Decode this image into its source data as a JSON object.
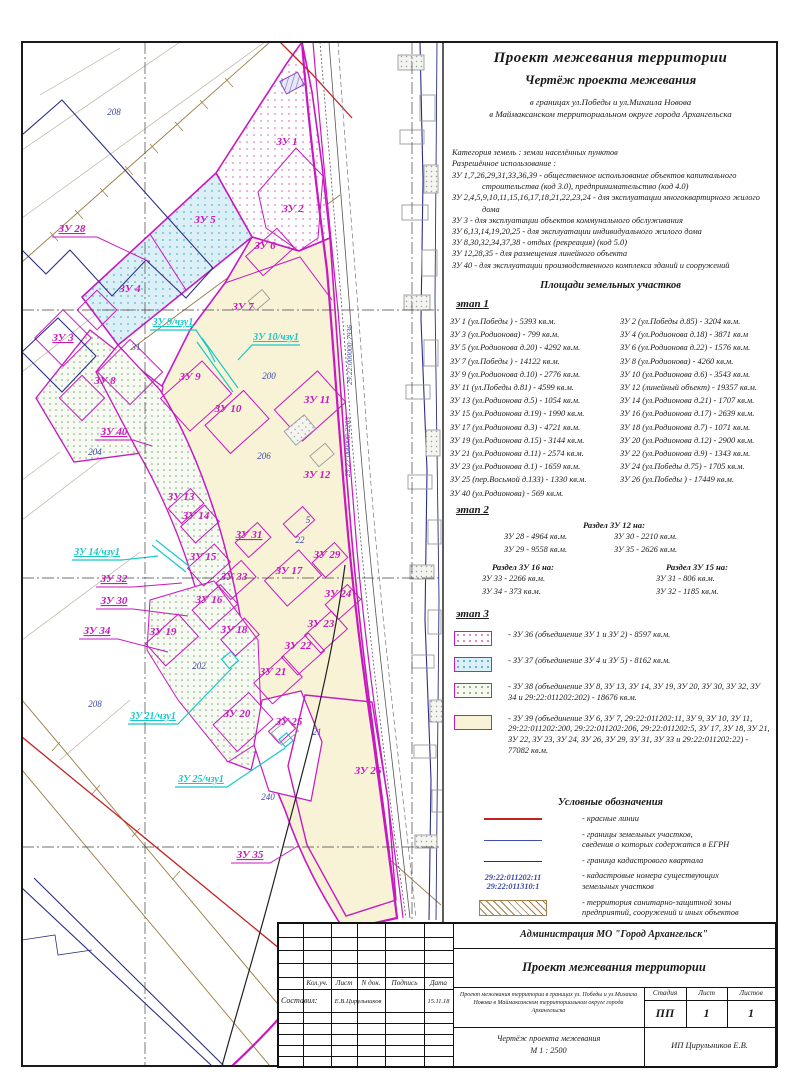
{
  "header": {
    "title": "Проект межевания территории",
    "subtitle": "Чертёж проекта межевания",
    "scope_line1": "в границах ул.Победы и ул.Михаила Новова",
    "scope_line2": "в Маймаксанском территориальном округе города Архангельска"
  },
  "category": {
    "line1": "Категория земель : земли населённых пунктов",
    "line2": "Разрешённое использование :",
    "uses": [
      "ЗУ 1,7,26,29,31,33,36,39 - общественное использование объектов капитального строительства (код 3.0), предпринимательство (код 4.0)",
      "ЗУ 2,4,5,9,10,11,15,16,17,18,21,22,23,24 - для эксплуатации многоквартирного жилого дома",
      "ЗУ 3 - для эксплуатации объектов коммунального обслуживания",
      "ЗУ 6,13,14,19,20,25 - для эксплуатации индивидуального жилого дома",
      "ЗУ 8,30,32,34,37,38 - отдых (рекреация) (код 5.0)",
      "ЗУ 12,28,35 - для размещения линейного объекта",
      "ЗУ 40 - для эксплуатации производственного комплекса зданий и сооружений"
    ]
  },
  "areas": {
    "heading": "Площади земельных участков",
    "stage1": {
      "label": "этап 1",
      "rows": [
        {
          "left": "ЗУ 1 (ул.Победы ) - 5393 кв.м.",
          "right": "ЗУ 2 (ул.Победы д.85) - 3204 кв.м."
        },
        {
          "left": "ЗУ 3 (ул.Родионова) - 799 кв.м.",
          "right": "ЗУ 4 (ул.Родионова д.18) - 3871 кв.м"
        },
        {
          "left": "ЗУ 5 (ул.Родионова д.20) - 4292 кв.м.",
          "right": "ЗУ 6 (ул.Родионова д.22) - 1576 кв.м."
        },
        {
          "left": "ЗУ 7 (ул.Победы ) - 14122 кв.м.",
          "right": "ЗУ 8 (ул.Родионова) - 4260 кв.м."
        },
        {
          "left": "ЗУ 9 (ул.Родионова д.10) - 2776 кв.м.",
          "right": "ЗУ 10 (ул.Родионова д.6) - 3543 кв.м."
        },
        {
          "left": "ЗУ 11 (ул.Победы д.81) - 4599 кв.м.",
          "right": "ЗУ 12 (линейный объект) - 19357 кв.м."
        },
        {
          "left": "ЗУ 13 (ул.Родионова д.5) - 1054 кв.м.",
          "right": "ЗУ 14 (ул.Родионова д.21) - 1707 кв.м."
        },
        {
          "left": "ЗУ 15 (ул.Родионова д.19) - 1990 кв.м.",
          "right": "ЗУ 16 (ул.Родионова д.17) - 2639 кв.м."
        },
        {
          "left": "ЗУ 17 (ул.Родионова д.3) - 4721 кв.м.",
          "right": "ЗУ 18 (ул.Родионова д.7) - 1071 кв.м."
        },
        {
          "left": "ЗУ 19 (ул.Родионова д.15) - 3144 кв.м.",
          "right": "ЗУ 20 (ул.Родионова д.12) - 2900 кв.м."
        },
        {
          "left": "ЗУ 21 (ул.Родионова д.11) - 2574 кв.м.",
          "right": "ЗУ 22 (ул.Родионова д.9) - 1343 кв.м."
        },
        {
          "left": "ЗУ 23 (ул.Родионова д.1) - 1659 кв.м.",
          "right": "ЗУ 24 (ул.Победы д.75) - 1705 кв.м."
        },
        {
          "left": "ЗУ 25 (пер.Восьмой д.133) - 1330 кв.м.",
          "right": "ЗУ 26 (ул.Победы ) - 17449 кв.м."
        },
        {
          "left": "ЗУ 40 (ул.Родионова) - 569 кв.м.",
          "right": ""
        }
      ]
    },
    "stage2": {
      "label": "этап 2",
      "split12": {
        "title": "Раздел ЗУ 12 на:",
        "left": [
          "ЗУ 28 - 4964 кв.м.",
          "ЗУ 29 - 9558 кв.м."
        ],
        "right": [
          "ЗУ 30 - 2210 кв.м.",
          "ЗУ 35 - 2626 кв.м."
        ]
      },
      "split16": {
        "title": "Раздел ЗУ 16 на:",
        "rows": [
          "ЗУ 33 - 2266 кв.м.",
          "ЗУ 34 - 373 кв.м."
        ]
      },
      "split15": {
        "title": "Раздел ЗУ 15 на:",
        "rows": [
          "ЗУ 31 - 806 кв.м.",
          "ЗУ 32 - 1185 кв.м."
        ]
      }
    },
    "stage3": {
      "label": "этап 3",
      "items": [
        {
          "swatch": "pink",
          "text": "- ЗУ 36 (объединение ЗУ 1 и ЗУ 2) - 8597 кв.м."
        },
        {
          "swatch": "cyan",
          "text": "- ЗУ 37 (объединение ЗУ 4 и ЗУ 5) - 8162 кв.м."
        },
        {
          "swatch": "green",
          "text": "- ЗУ 38 (объединение ЗУ 8, ЗУ 13, ЗУ 14, ЗУ 19, ЗУ 20, ЗУ 30, ЗУ 32, ЗУ 34 и 29:22:011202:202) - 18676 кв.м."
        },
        {
          "swatch": "beige",
          "text": "- ЗУ 39 (объединение ЗУ 6, ЗУ 7, 29:22:011202:11, ЗУ 9, ЗУ 10, ЗУ 11, 29:22:011202:200, 29:22:011202:206, 29:22:011202:5, ЗУ 17, ЗУ 18, ЗУ 21, ЗУ 22, ЗУ 23, ЗУ 24, ЗУ 26, ЗУ 29, ЗУ 31, ЗУ 33 и 29:22:011202:22) - 77082 кв.м."
        }
      ]
    }
  },
  "legend": {
    "heading": "Условные обозначения",
    "items": [
      {
        "symbol": "red-line",
        "lines": [
          "- красные линии"
        ]
      },
      {
        "symbol": "egrn-line",
        "lines": [
          "- границы земельных участков,",
          "сведения о которых содержатся в ЕГРН"
        ]
      },
      {
        "symbol": "quarter-line",
        "lines": [
          "- граница кадастрового квартала"
        ]
      },
      {
        "symbol": "cadastral-numbers",
        "numbers": [
          "29:22:011202:11",
          "29:22:011310:1"
        ],
        "lines": [
          "- кадастровые номера существующих",
          "земельных участков"
        ]
      },
      {
        "symbol": "szz-hatch",
        "lines": [
          "- территория санитарно-защитной зоны",
          "предприятий, сооружений и иных объектов"
        ]
      },
      {
        "symbol": "planned-rect",
        "lines": [
          "- границы земельных участков,",
          "планируемых к предоставлению"
        ]
      }
    ]
  },
  "title_block": {
    "org": "Администрация МО \"Город Архангельск\"",
    "doc_title": "Проект межевания территории",
    "col_headers": [
      "Кол.уч.",
      "Лист",
      "N док.",
      "Подпись",
      "Дата"
    ],
    "compiled_label": "Составил:",
    "compiled_name": "Е.В.Цирульников",
    "compiled_date": "15.11.18",
    "description": "Проект межевания территории в границах ул. Победы и ул.Михаила Новова в Маймаксанском территориальном округе города Архангельска",
    "stage_label": "Стадия",
    "sheet_label": "Лист",
    "sheets_label": "Листов",
    "stage_value": "ПП",
    "sheet_value": "1",
    "sheets_value": "1",
    "drawing_title": "Чертёж проекта межевания",
    "scale": "М 1 : 2500",
    "company": "ИП Цирульников Е.В."
  },
  "colors": {
    "plot_boundary": "#c818c0",
    "red_line": "#c32222",
    "egrn_line": "#4050b8",
    "quarter_line": "#283080",
    "cyan_part": "#18c8c8",
    "beige_fill": "#f8f3d7",
    "hatch_brown": "#a08048",
    "number_blue": "#3a46a8"
  },
  "map": {
    "labels": [
      {
        "t": "ЗУ 1",
        "x": 287,
        "y": 145,
        "c": "zu"
      },
      {
        "t": "ЗУ 2",
        "x": 293,
        "y": 212,
        "c": "zu"
      },
      {
        "t": "ЗУ 5",
        "x": 205,
        "y": 223,
        "c": "zu"
      },
      {
        "t": "ЗУ 6",
        "x": 265,
        "y": 249,
        "c": "zu"
      },
      {
        "t": "ЗУ 4",
        "x": 130,
        "y": 292,
        "c": "zu"
      },
      {
        "t": "ЗУ 7",
        "x": 243,
        "y": 310,
        "c": "zu"
      },
      {
        "t": "ЗУ 28",
        "x": 72,
        "y": 232,
        "c": "zu",
        "u": 1
      },
      {
        "t": "ЗУ 3",
        "x": 63,
        "y": 341,
        "c": "zu",
        "u": 1
      },
      {
        "t": "ЗУ 8",
        "x": 105,
        "y": 384,
        "c": "zu"
      },
      {
        "t": "ЗУ 9",
        "x": 190,
        "y": 380,
        "c": "zu"
      },
      {
        "t": "ЗУ 10",
        "x": 228,
        "y": 412,
        "c": "zu"
      },
      {
        "t": "ЗУ 11",
        "x": 317,
        "y": 403,
        "c": "zu"
      },
      {
        "t": "ЗУ 40",
        "x": 114,
        "y": 435,
        "c": "zu",
        "u": 1
      },
      {
        "t": "ЗУ 12",
        "x": 317,
        "y": 478,
        "c": "zu"
      },
      {
        "t": "ЗУ 13",
        "x": 181,
        "y": 500,
        "c": "zu"
      },
      {
        "t": "ЗУ 14",
        "x": 196,
        "y": 519,
        "c": "zu"
      },
      {
        "t": "ЗУ 31",
        "x": 249,
        "y": 538,
        "c": "zu",
        "u": 1
      },
      {
        "t": "ЗУ 15",
        "x": 203,
        "y": 560,
        "c": "zu"
      },
      {
        "t": "ЗУ 29",
        "x": 327,
        "y": 558,
        "c": "zu"
      },
      {
        "t": "ЗУ 17",
        "x": 289,
        "y": 574,
        "c": "zu"
      },
      {
        "t": "ЗУ 32",
        "x": 114,
        "y": 582,
        "c": "zu",
        "u": 1
      },
      {
        "t": "ЗУ 33",
        "x": 234,
        "y": 580,
        "c": "zu"
      },
      {
        "t": "ЗУ 30",
        "x": 114,
        "y": 604,
        "c": "zu",
        "u": 1
      },
      {
        "t": "ЗУ 16",
        "x": 209,
        "y": 603,
        "c": "zu"
      },
      {
        "t": "ЗУ 24",
        "x": 338,
        "y": 597,
        "c": "zu"
      },
      {
        "t": "ЗУ 34",
        "x": 97,
        "y": 634,
        "c": "zu",
        "u": 1
      },
      {
        "t": "ЗУ 19",
        "x": 163,
        "y": 635,
        "c": "zu"
      },
      {
        "t": "ЗУ 18",
        "x": 234,
        "y": 633,
        "c": "zu"
      },
      {
        "t": "ЗУ 23",
        "x": 321,
        "y": 627,
        "c": "zu"
      },
      {
        "t": "ЗУ 22",
        "x": 298,
        "y": 649,
        "c": "zu"
      },
      {
        "t": "ЗУ 21",
        "x": 273,
        "y": 675,
        "c": "zu"
      },
      {
        "t": "ЗУ 20",
        "x": 237,
        "y": 717,
        "c": "zu"
      },
      {
        "t": "ЗУ 25",
        "x": 289,
        "y": 725,
        "c": "zu"
      },
      {
        "t": "ЗУ 26",
        "x": 368,
        "y": 774,
        "c": "zu"
      },
      {
        "t": "ЗУ 35",
        "x": 250,
        "y": 858,
        "c": "zu",
        "u": 1
      },
      {
        "t": "ЗУ 9/чзу1",
        "x": 173,
        "y": 325,
        "c": "cy",
        "u": 1
      },
      {
        "t": "ЗУ 10/чзу1",
        "x": 276,
        "y": 340,
        "c": "cy",
        "u": 1
      },
      {
        "t": "ЗУ 14/чзу1",
        "x": 97,
        "y": 555,
        "c": "cy",
        "u": 1
      },
      {
        "t": "ЗУ 21/чзу1",
        "x": 153,
        "y": 719,
        "c": "cy",
        "u": 1
      },
      {
        "t": "ЗУ 25/чзу1",
        "x": 201,
        "y": 782,
        "c": "cy",
        "u": 1
      },
      {
        "t": "208",
        "x": 114,
        "y": 115,
        "c": "num"
      },
      {
        "t": "204",
        "x": 95,
        "y": 455,
        "c": "num"
      },
      {
        "t": "200",
        "x": 269,
        "y": 379,
        "c": "num"
      },
      {
        "t": "206",
        "x": 264,
        "y": 459,
        "c": "num"
      },
      {
        "t": "202",
        "x": 199,
        "y": 669,
        "c": "num"
      },
      {
        "t": "208",
        "x": 95,
        "y": 707,
        "c": "num"
      },
      {
        "t": "31",
        "x": 136,
        "y": 350,
        "c": "num"
      },
      {
        "t": "22",
        "x": 300,
        "y": 543,
        "c": "num"
      },
      {
        "t": "5",
        "x": 308,
        "y": 523,
        "c": "num"
      },
      {
        "t": "21",
        "x": 317,
        "y": 735,
        "c": "num"
      },
      {
        "t": "240",
        "x": 268,
        "y": 800,
        "c": "num"
      },
      {
        "t": "29:22:000000:7936",
        "x": 352,
        "y": 355,
        "c": "road",
        "r": -90
      },
      {
        "t": "29:22:000000:2263",
        "x": 350,
        "y": 447,
        "c": "road",
        "r": -90
      }
    ]
  }
}
